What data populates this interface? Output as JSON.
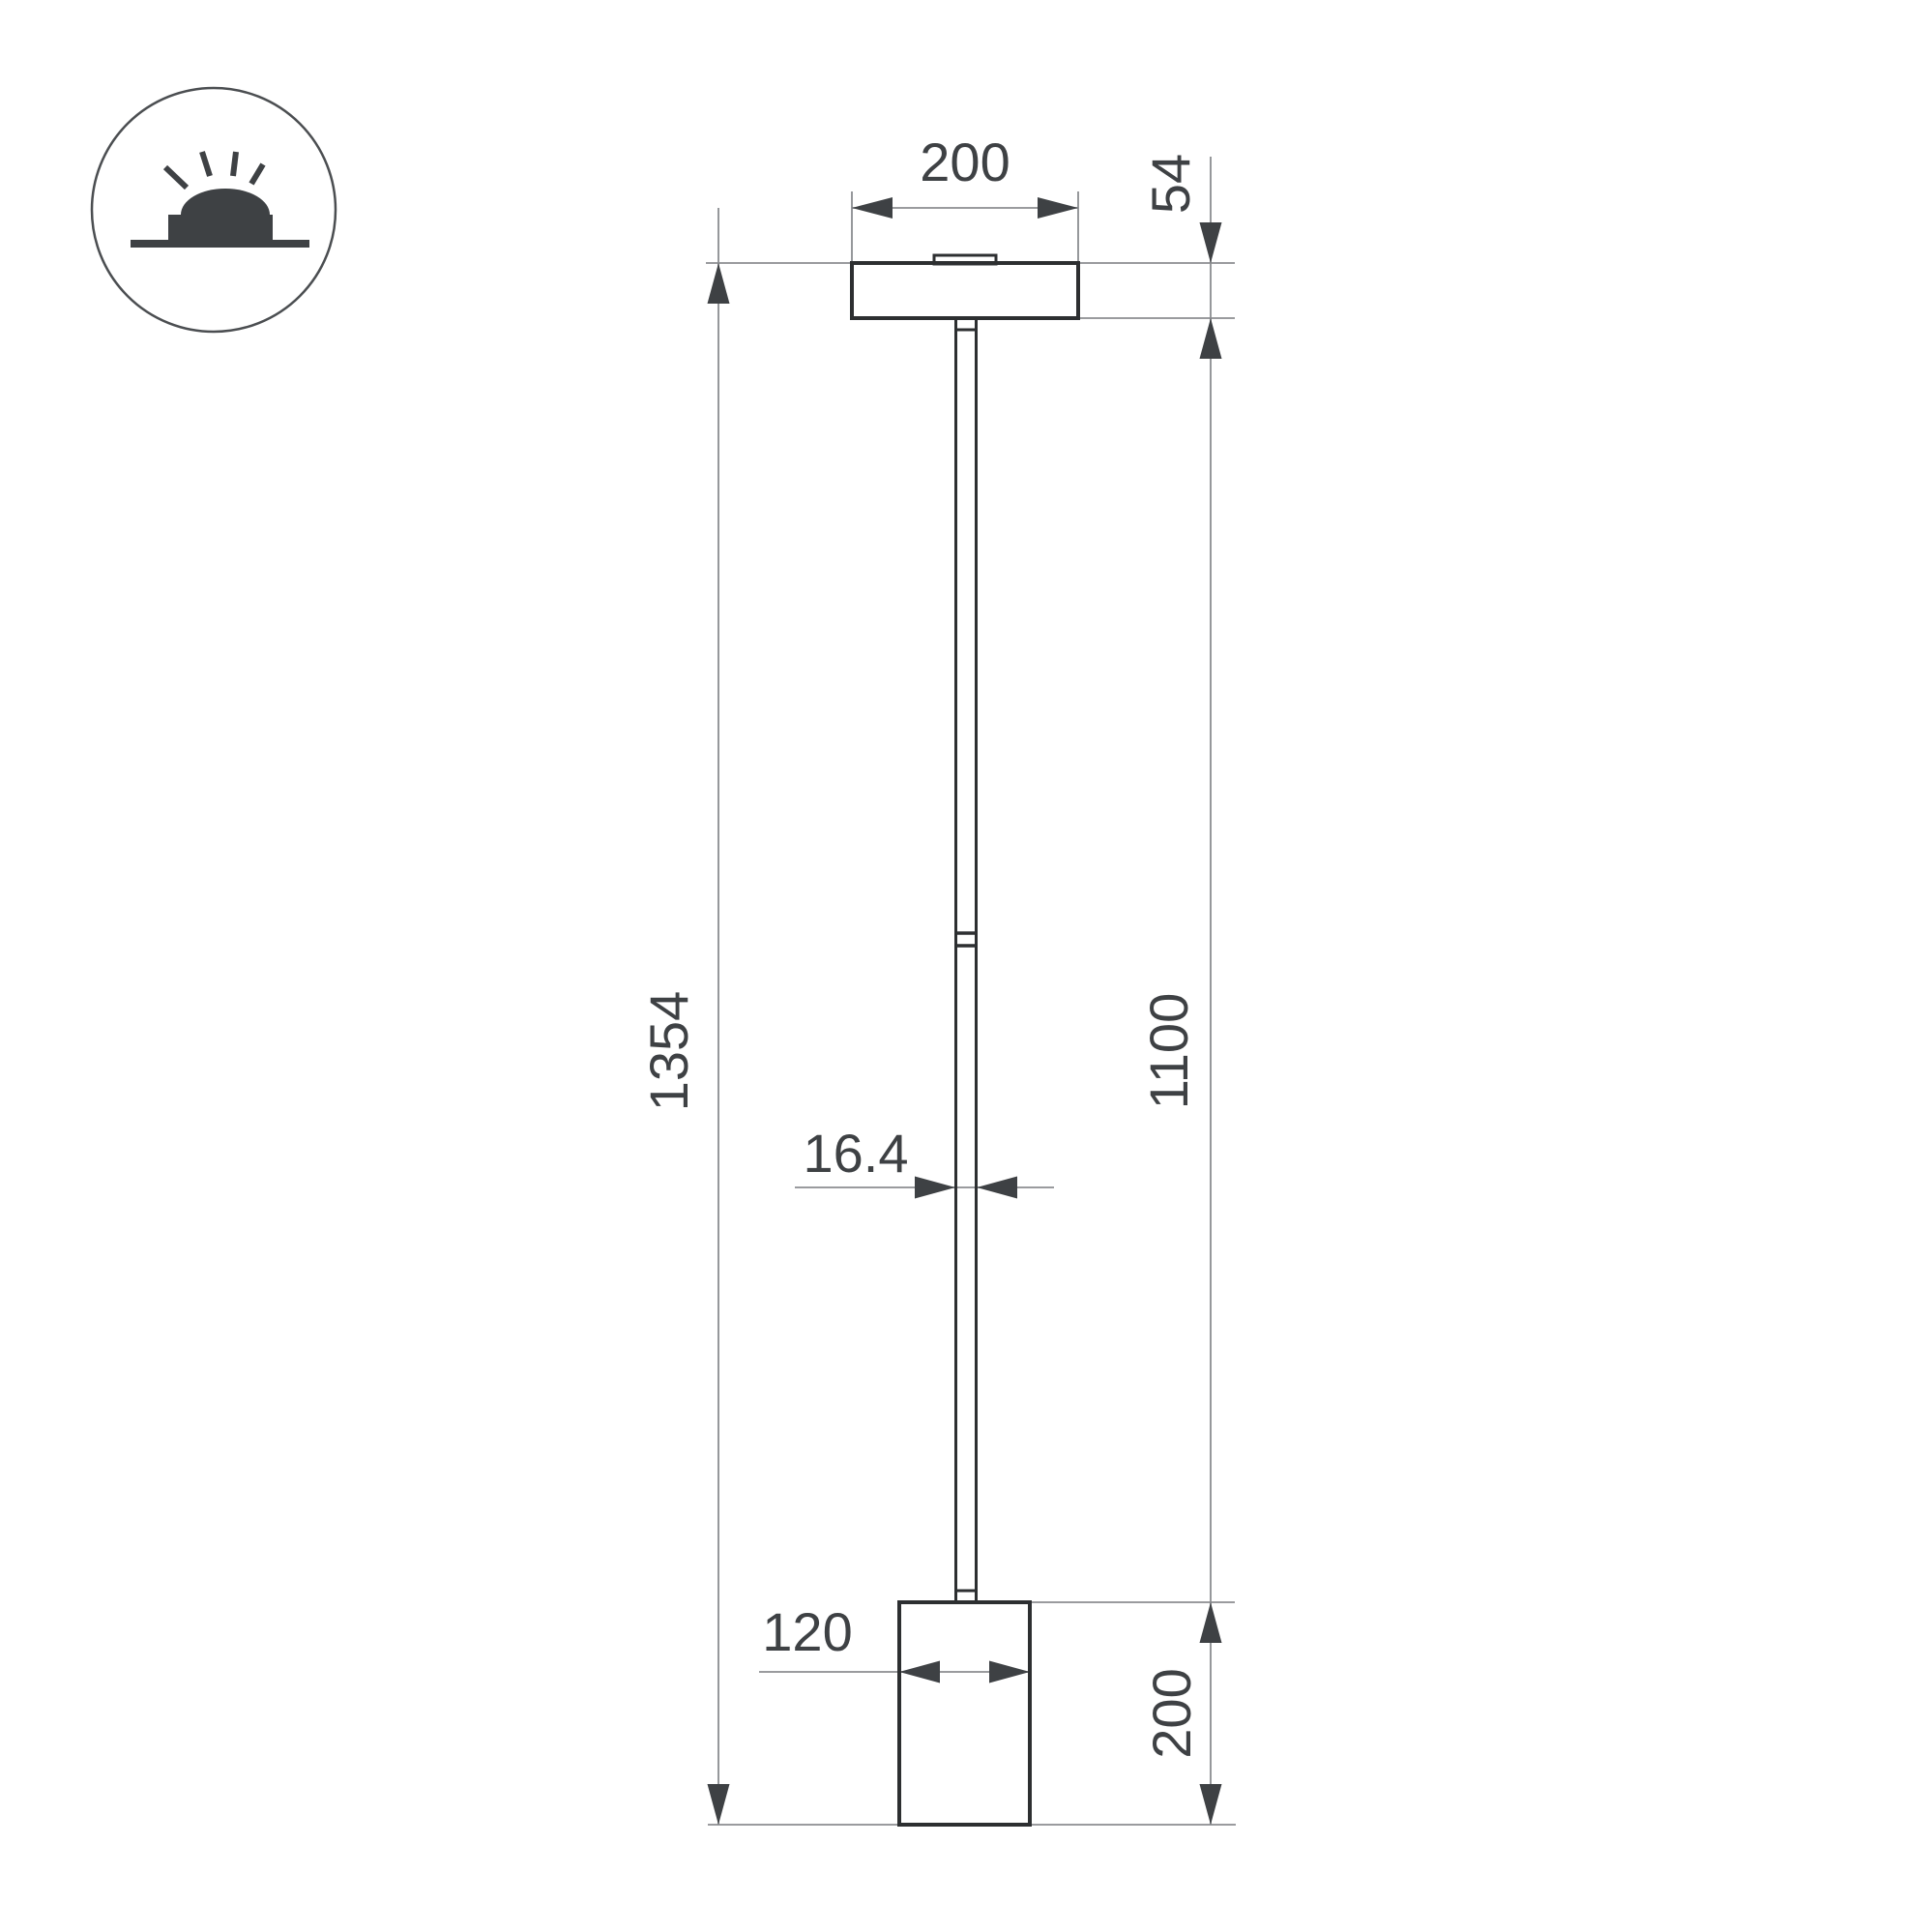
{
  "page": {
    "background": "#ffffff"
  },
  "icon": {
    "name": "surface-mounted-luminaire-icon"
  },
  "dimensions": {
    "canopy_width": "200",
    "canopy_height": "54",
    "overall_height": "1354",
    "rod_length": "1100",
    "rod_diameter": "16.4",
    "head_width": "120",
    "head_height": "200"
  },
  "colors": {
    "outline": "#2d2f31",
    "dimension_line": "#8b8d90",
    "annotation": "#3e4144"
  }
}
